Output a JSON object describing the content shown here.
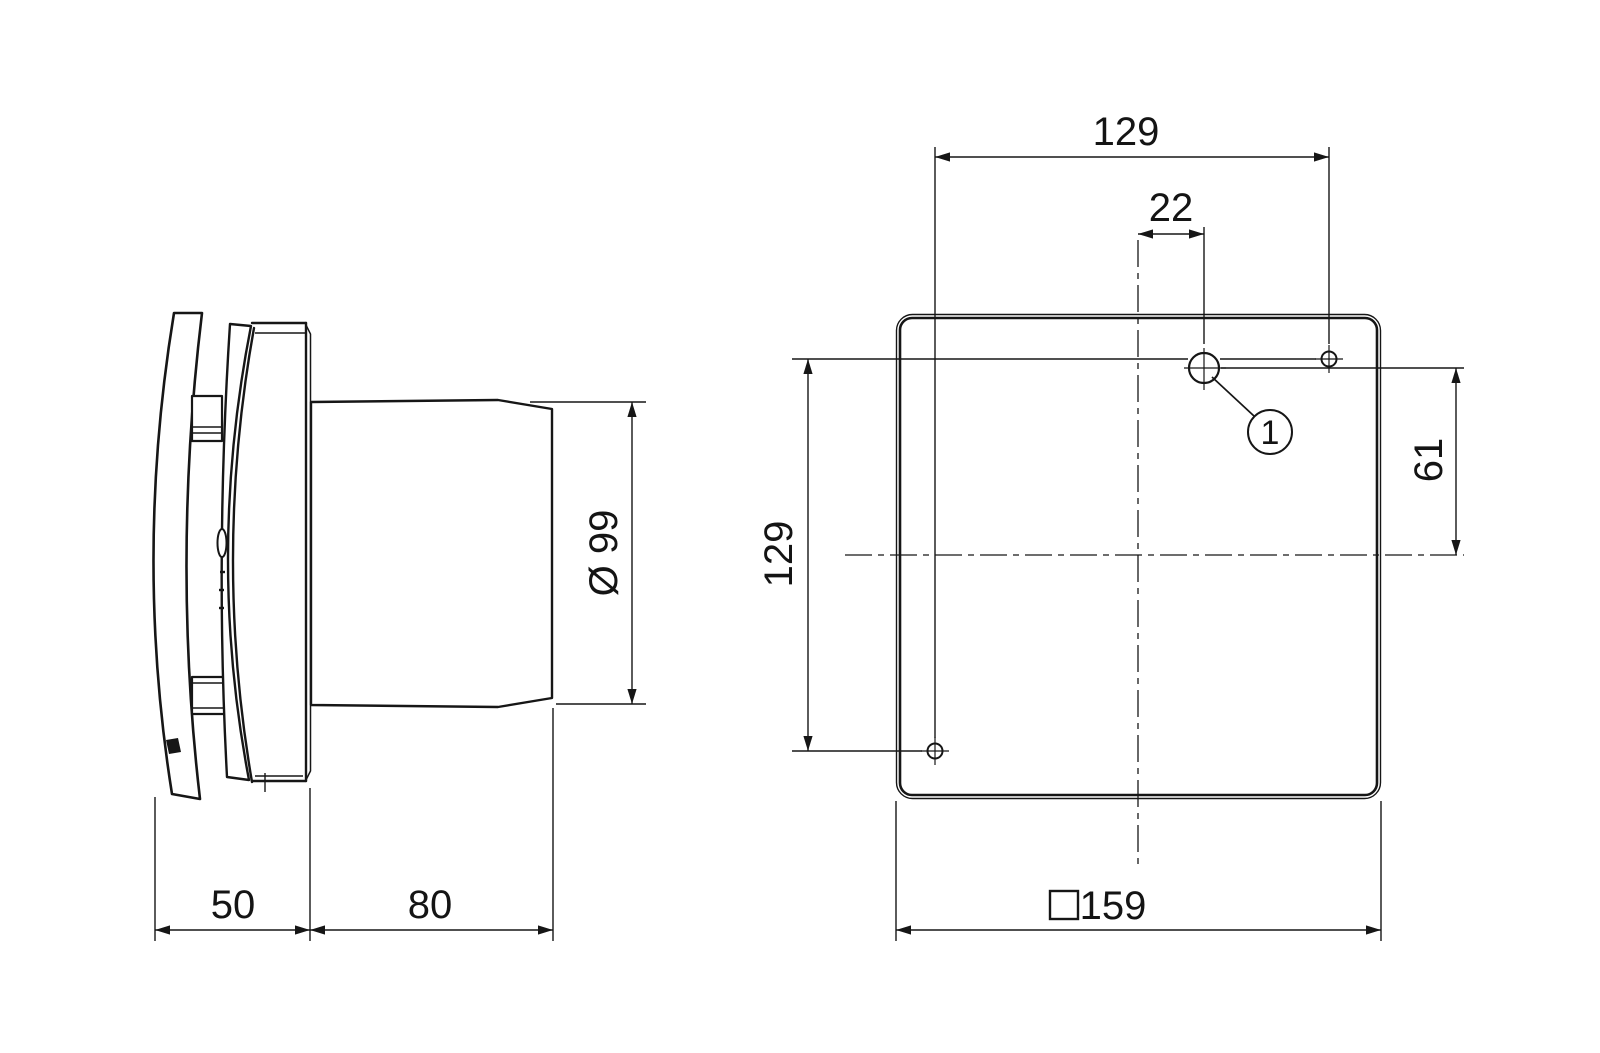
{
  "page": {
    "background_color": "#ffffff",
    "line_color": "#161616",
    "description_labels": {
      "drawing_type": "dimensional-drawing"
    }
  },
  "side_view": {
    "dim_front_depth": "50",
    "dim_duct_length": "80",
    "dim_duct_diameter": "Ø 99"
  },
  "front_view": {
    "dim_hole_spacing_horizontal": "129",
    "dim_hole_offset_horizontal": "22",
    "dim_hole_offset_vertical": "61",
    "dim_hole_spacing_vertical": "129",
    "dim_plate_size": "159",
    "plate_size_symbol": "square",
    "callout_label": "1"
  }
}
